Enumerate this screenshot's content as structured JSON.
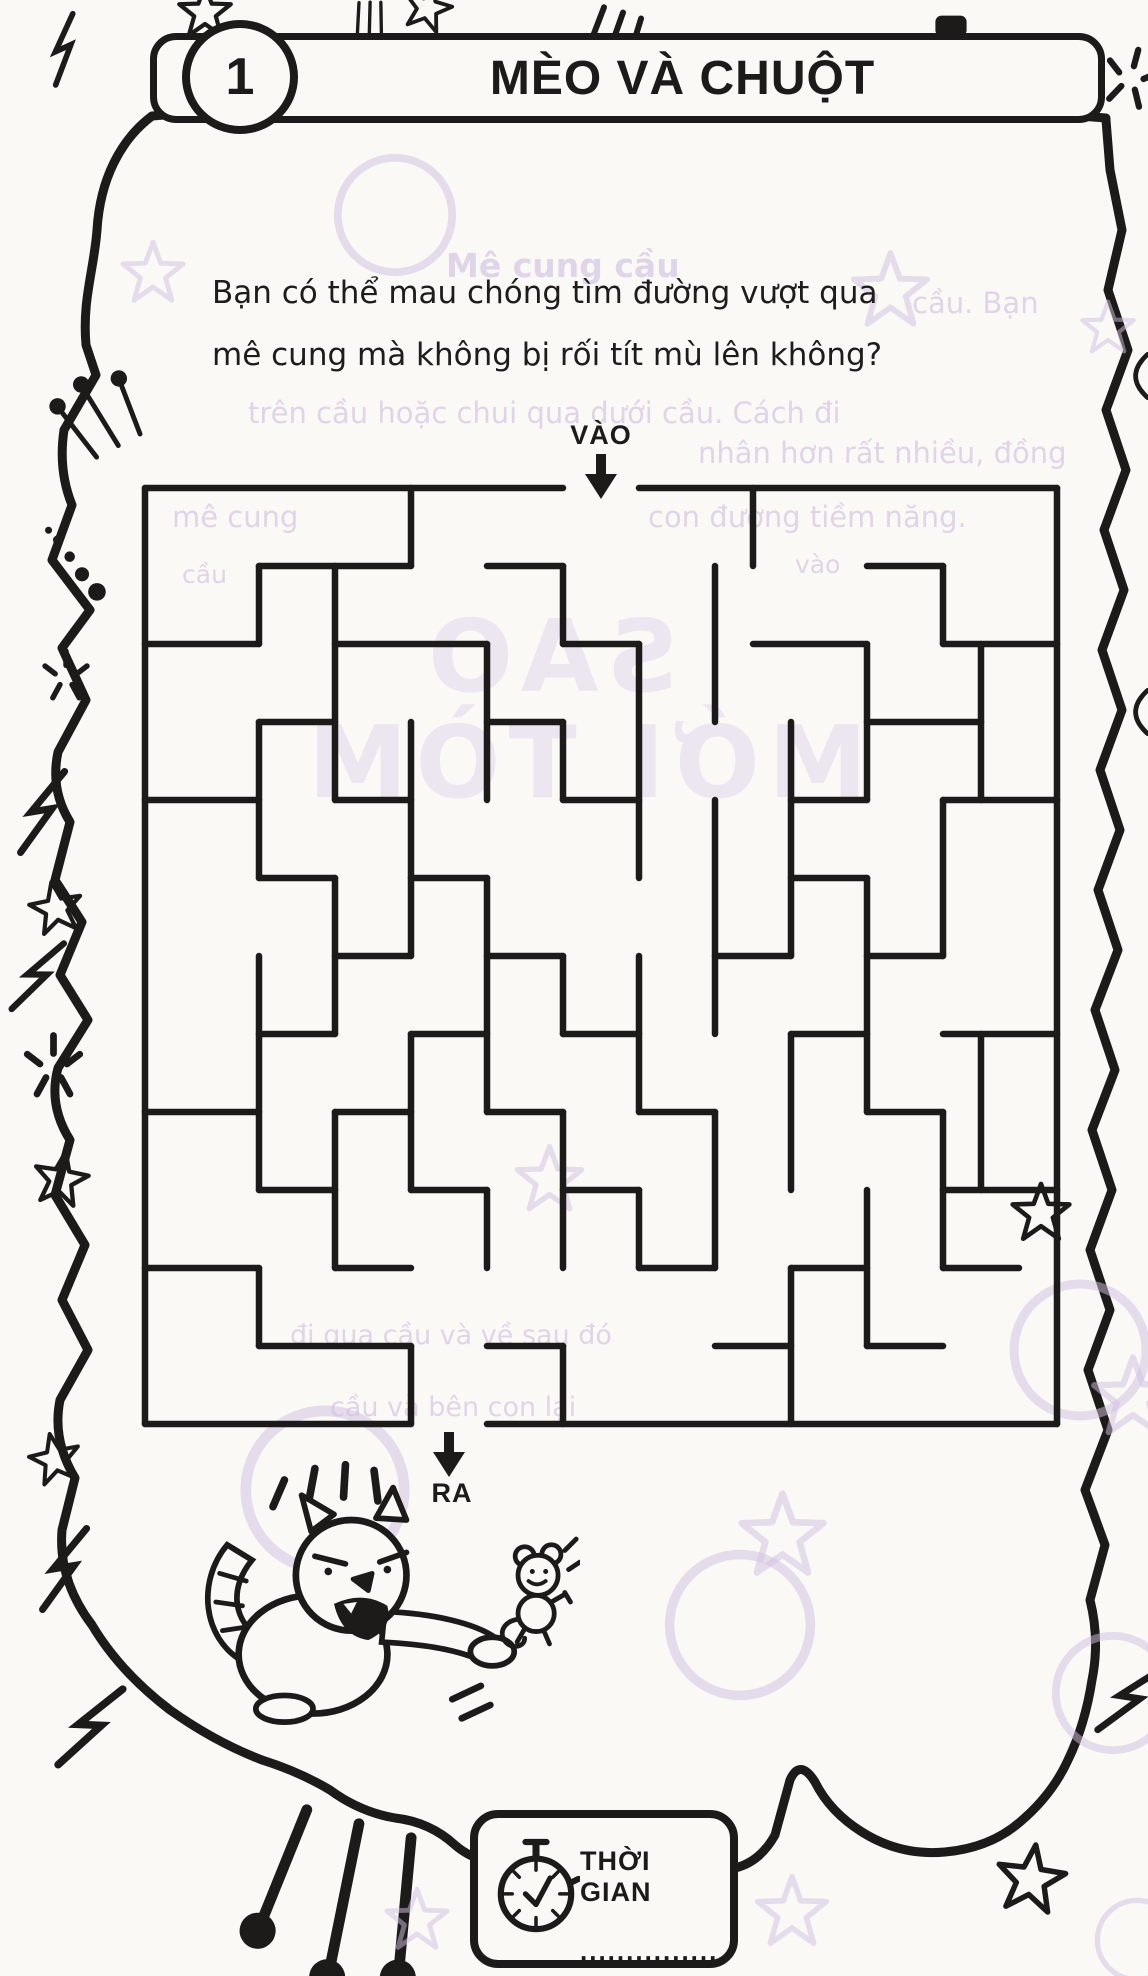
{
  "page": {
    "ink": "#1d1b19",
    "paper": "#faf9f6",
    "bleed_color": "#cbb6de"
  },
  "header": {
    "number": "1",
    "title": "MÈO VÀ CHUỘT"
  },
  "intro": {
    "line1": "Bạn có thể mau chóng tìm đường vượt qua",
    "line2": "mê cung mà không bị rối tít mù lên không?"
  },
  "maze": {
    "entry_label": "VÀO",
    "exit_label": "RA",
    "cols": 12,
    "rows": 12,
    "cell_w": 76,
    "cell_h": 78,
    "segments": [
      [
        0,
        0,
        5.5,
        0
      ],
      [
        6.5,
        0,
        12,
        0
      ],
      [
        12,
        0,
        12,
        12
      ],
      [
        4.5,
        12,
        12,
        12
      ],
      [
        0,
        12,
        3.5,
        12
      ],
      [
        0,
        0,
        0,
        12
      ],
      [
        3.5,
        0,
        3.5,
        1
      ],
      [
        8,
        0,
        8,
        1
      ],
      [
        1.5,
        1,
        1.5,
        2
      ],
      [
        2.5,
        1,
        2.5,
        4
      ],
      [
        5.5,
        1,
        5.5,
        2
      ],
      [
        7.5,
        1,
        7.5,
        3
      ],
      [
        10.5,
        1,
        10.5,
        2
      ],
      [
        4.5,
        2,
        4.5,
        4
      ],
      [
        6.5,
        2,
        6.5,
        5
      ],
      [
        9.5,
        2,
        9.5,
        4
      ],
      [
        11,
        2,
        11,
        4
      ],
      [
        1.5,
        3,
        1.5,
        5
      ],
      [
        3.5,
        3,
        3.5,
        6
      ],
      [
        5.5,
        3,
        5.5,
        4
      ],
      [
        8.5,
        3,
        8.5,
        6
      ],
      [
        2.5,
        5,
        2.5,
        7
      ],
      [
        4.5,
        5,
        4.5,
        8
      ],
      [
        7.5,
        4,
        7.5,
        7
      ],
      [
        10.5,
        4,
        10.5,
        6
      ],
      [
        6.5,
        6,
        6.5,
        8
      ],
      [
        9.5,
        5,
        9.5,
        8
      ],
      [
        1.5,
        6,
        1.5,
        9
      ],
      [
        5.5,
        6,
        5.5,
        7
      ],
      [
        11,
        7,
        11,
        9
      ],
      [
        3.5,
        7,
        3.5,
        9
      ],
      [
        8.5,
        7,
        8.5,
        9
      ],
      [
        2.5,
        8,
        2.5,
        10
      ],
      [
        5.5,
        8,
        5.5,
        10
      ],
      [
        7.5,
        8,
        7.5,
        10
      ],
      [
        10.5,
        8,
        10.5,
        10
      ],
      [
        4.5,
        9,
        4.5,
        10
      ],
      [
        6.5,
        9,
        6.5,
        10
      ],
      [
        9.5,
        9,
        9.5,
        11
      ],
      [
        1.5,
        10,
        1.5,
        11
      ],
      [
        3.5,
        11,
        3.5,
        12
      ],
      [
        5.5,
        11,
        5.5,
        12
      ],
      [
        8.5,
        10,
        8.5,
        12
      ],
      [
        1.5,
        1,
        3.5,
        1
      ],
      [
        4.5,
        1,
        5.5,
        1
      ],
      [
        9.5,
        1,
        10.5,
        1
      ],
      [
        0,
        2,
        1.5,
        2
      ],
      [
        2.5,
        2,
        4.5,
        2
      ],
      [
        5.5,
        2,
        6.5,
        2
      ],
      [
        8,
        2,
        9.5,
        2
      ],
      [
        10.5,
        2,
        12,
        2
      ],
      [
        1.5,
        3,
        2.5,
        3
      ],
      [
        4.5,
        3,
        5.5,
        3
      ],
      [
        9.5,
        3,
        11,
        3
      ],
      [
        0,
        4,
        1.5,
        4
      ],
      [
        2.5,
        4,
        3.5,
        4
      ],
      [
        5.5,
        4,
        6.5,
        4
      ],
      [
        8.5,
        4,
        9.5,
        4
      ],
      [
        10.5,
        4,
        12,
        4
      ],
      [
        1.5,
        5,
        2.5,
        5
      ],
      [
        3.5,
        5,
        4.5,
        5
      ],
      [
        8.5,
        5,
        9.5,
        5
      ],
      [
        2.5,
        6,
        3.5,
        6
      ],
      [
        4.5,
        6,
        5.5,
        6
      ],
      [
        7.5,
        6,
        8.5,
        6
      ],
      [
        9.5,
        6,
        10.5,
        6
      ],
      [
        1.5,
        7,
        2.5,
        7
      ],
      [
        3.5,
        7,
        4.5,
        7
      ],
      [
        5.5,
        7,
        6.5,
        7
      ],
      [
        8.5,
        7,
        9.5,
        7
      ],
      [
        10.5,
        7,
        12,
        7
      ],
      [
        0,
        8,
        1.5,
        8
      ],
      [
        2.5,
        8,
        3.5,
        8
      ],
      [
        4.5,
        8,
        5.5,
        8
      ],
      [
        6.5,
        8,
        7.5,
        8
      ],
      [
        9.5,
        8,
        10.5,
        8
      ],
      [
        1.5,
        9,
        2.5,
        9
      ],
      [
        3.5,
        9,
        4.5,
        9
      ],
      [
        5.5,
        9,
        6.5,
        9
      ],
      [
        10.5,
        9,
        12,
        9
      ],
      [
        0,
        10,
        1.5,
        10
      ],
      [
        2.5,
        10,
        3.5,
        10
      ],
      [
        6.5,
        10,
        7.5,
        10
      ],
      [
        8.5,
        10,
        9.5,
        10
      ],
      [
        10.5,
        10,
        11.5,
        10
      ],
      [
        1.5,
        11,
        3.5,
        11
      ],
      [
        4.5,
        11,
        5.5,
        11
      ],
      [
        7.5,
        11,
        8.5,
        11
      ],
      [
        9.5,
        11,
        10.5,
        11
      ]
    ]
  },
  "timer": {
    "label": "THỜI GIAN",
    "dots": "..............."
  },
  "illustration": {
    "name": "angry-cat-chasing-mouse"
  },
  "bleedthrough": {
    "texts": [
      {
        "text": "Mê cung cầu",
        "x": 446,
        "y": 246,
        "size": 33,
        "bold": true
      },
      {
        "text": "cầu. Bạn",
        "x": 912,
        "y": 286,
        "size": 29
      },
      {
        "text": "trên cầu hoặc chui qua dưới cầu. Cách đi",
        "x": 248,
        "y": 396,
        "size": 29
      },
      {
        "text": "nhân hơn rất nhiều, đồng",
        "x": 698,
        "y": 436,
        "size": 29
      },
      {
        "text": "mê cung",
        "x": 172,
        "y": 500,
        "size": 29
      },
      {
        "text": "con đường tiềm năng.",
        "x": 648,
        "y": 500,
        "size": 29
      },
      {
        "text": "vào",
        "x": 795,
        "y": 550,
        "size": 25
      },
      {
        "text": "cầu",
        "x": 182,
        "y": 560,
        "size": 25
      },
      {
        "text": "SAO",
        "x": 420,
        "y": 598,
        "size": 100,
        "big": true
      },
      {
        "text": "MỚI TÒM",
        "x": 300,
        "y": 704,
        "size": 100,
        "big": true
      },
      {
        "text": "đi qua cầu và về sau đó",
        "x": 290,
        "y": 1320,
        "size": 27
      },
      {
        "text": "cầu và bên con lại",
        "x": 330,
        "y": 1392,
        "size": 27
      }
    ]
  },
  "decorations": [
    {
      "type": "lightning",
      "x": 38,
      "y": 12,
      "s": 70,
      "r": -15
    },
    {
      "type": "star",
      "x": 175,
      "y": -18,
      "s": 60,
      "r": 0
    },
    {
      "type": "tally",
      "x": 345,
      "y": -6,
      "s": 48,
      "r": -10
    },
    {
      "type": "star",
      "x": 400,
      "y": -20,
      "s": 55,
      "r": 15
    },
    {
      "type": "tally",
      "x": 570,
      "y": -4,
      "s": 85,
      "r": 8
    },
    {
      "type": "blob",
      "x": 925,
      "y": 0,
      "s": 52,
      "r": 0
    },
    {
      "type": "sparkle",
      "x": 1096,
      "y": 42,
      "s": 70,
      "r": 15
    },
    {
      "type": "arc",
      "x": 1114,
      "y": 352,
      "s": 48,
      "r": 0
    },
    {
      "type": "arc",
      "x": 1114,
      "y": 688,
      "s": 48,
      "r": 0
    },
    {
      "type": "antenna",
      "x": 60,
      "y": 372,
      "s": 82,
      "r": -28
    },
    {
      "type": "dots",
      "x": 38,
      "y": 525,
      "s": 88,
      "r": 0
    },
    {
      "type": "sparkle",
      "x": 36,
      "y": 645,
      "s": 60,
      "r": 0
    },
    {
      "type": "lightning",
      "x": 10,
      "y": 768,
      "s": 88,
      "r": 0
    },
    {
      "type": "star",
      "x": 26,
      "y": 878,
      "s": 60,
      "r": -10
    },
    {
      "type": "lightning",
      "x": 8,
      "y": 938,
      "s": 80,
      "r": 10
    },
    {
      "type": "sparkle",
      "x": 16,
      "y": 1028,
      "s": 75,
      "r": 0
    },
    {
      "type": "star",
      "x": 30,
      "y": 1148,
      "s": 62,
      "r": 10
    },
    {
      "type": "star",
      "x": 1008,
      "y": 1180,
      "s": 66,
      "r": 0
    },
    {
      "type": "star",
      "x": 26,
      "y": 1430,
      "s": 58,
      "r": -12
    },
    {
      "type": "lightning",
      "x": 32,
      "y": 1525,
      "s": 88,
      "r": 0
    },
    {
      "type": "lightning",
      "x": 55,
      "y": 1682,
      "s": 95,
      "r": 12
    },
    {
      "type": "antenna",
      "x": 248,
      "y": 1812,
      "s": 180,
      "r": 195
    },
    {
      "type": "sparkle",
      "x": 505,
      "y": 1828,
      "s": 78,
      "r": 0
    },
    {
      "type": "star",
      "x": 992,
      "y": 1840,
      "s": 78,
      "r": 8
    },
    {
      "type": "lightning",
      "x": 1098,
      "y": 1660,
      "s": 85,
      "r": 18
    },
    {
      "type": "ring",
      "x": 330,
      "y": 150,
      "s": 130,
      "r": 0,
      "faint": true
    },
    {
      "type": "star",
      "x": 118,
      "y": 238,
      "s": 70,
      "r": 0,
      "faint": true
    },
    {
      "type": "star",
      "x": 848,
      "y": 248,
      "s": 85,
      "r": 0,
      "faint": true
    },
    {
      "type": "star",
      "x": 1078,
      "y": 298,
      "s": 60,
      "r": 0,
      "faint": true
    },
    {
      "type": "star",
      "x": 512,
      "y": 1142,
      "s": 75,
      "r": 0,
      "faint": true
    },
    {
      "type": "ring",
      "x": 1005,
      "y": 1275,
      "s": 150,
      "r": 0,
      "faint": true
    },
    {
      "type": "ring",
      "x": 235,
      "y": 1400,
      "s": 180,
      "r": 0,
      "faint": true
    },
    {
      "type": "star",
      "x": 1088,
      "y": 1352,
      "s": 90,
      "r": 0,
      "faint": true
    },
    {
      "type": "ring",
      "x": 660,
      "y": 1545,
      "s": 160,
      "r": 0,
      "faint": true
    },
    {
      "type": "star",
      "x": 735,
      "y": 1488,
      "s": 95,
      "r": 0,
      "faint": true
    },
    {
      "type": "ring",
      "x": 1048,
      "y": 1628,
      "s": 130,
      "r": 0,
      "faint": true
    },
    {
      "type": "star",
      "x": 382,
      "y": 1885,
      "s": 70,
      "r": 0,
      "faint": true
    },
    {
      "type": "star",
      "x": 752,
      "y": 1872,
      "s": 80,
      "r": 0,
      "faint": true
    },
    {
      "type": "ring",
      "x": 1092,
      "y": 1895,
      "s": 90,
      "r": 0,
      "faint": true
    }
  ]
}
